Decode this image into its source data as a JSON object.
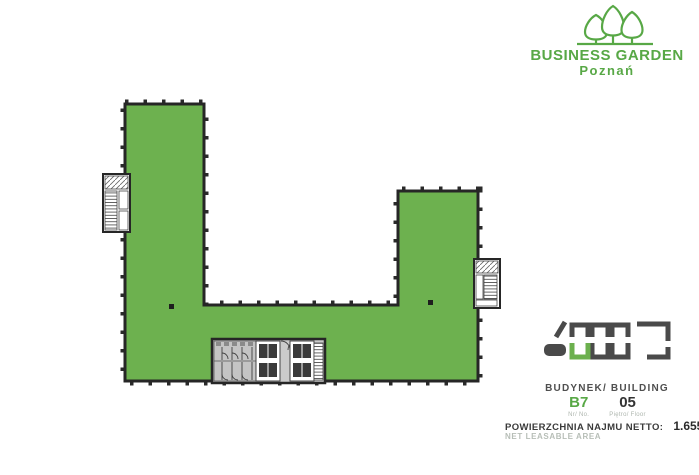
{
  "brand": {
    "title": "BUSINESS GARDEN",
    "city": "Poznań"
  },
  "plan": {
    "shape": "U-shaped office floor plate, leasable area highlighted green",
    "features": "left stairwell, right stairwell, central core with toilets, elevators and stairs",
    "fill_color": "#6DB14F",
    "wall_color": "#262626",
    "core_color": "#CBCBCB"
  },
  "info": {
    "building_label": "BUDYNEK/ BUILDING",
    "building_code": "B7",
    "floor_number": "05",
    "building_caption": "Nr/ No.",
    "floor_caption": "Piętro/ Floor",
    "area_label": "POWIERZCHNIA NAJMU NETTO:",
    "area_value": "1.655,48 m²",
    "area_sublabel": "NET LEASABLE AREA"
  },
  "colors": {
    "accent_green": "#58A846",
    "plan_green": "#6DB14F",
    "wall_dark": "#262626",
    "icon_gray": "#4A4A4A",
    "caption_gray": "#AEB6AE"
  },
  "icons": {
    "trees_logo": "three stylized trees above ground line",
    "site_plan": "row of building outlines, building B7 highlighted green"
  }
}
